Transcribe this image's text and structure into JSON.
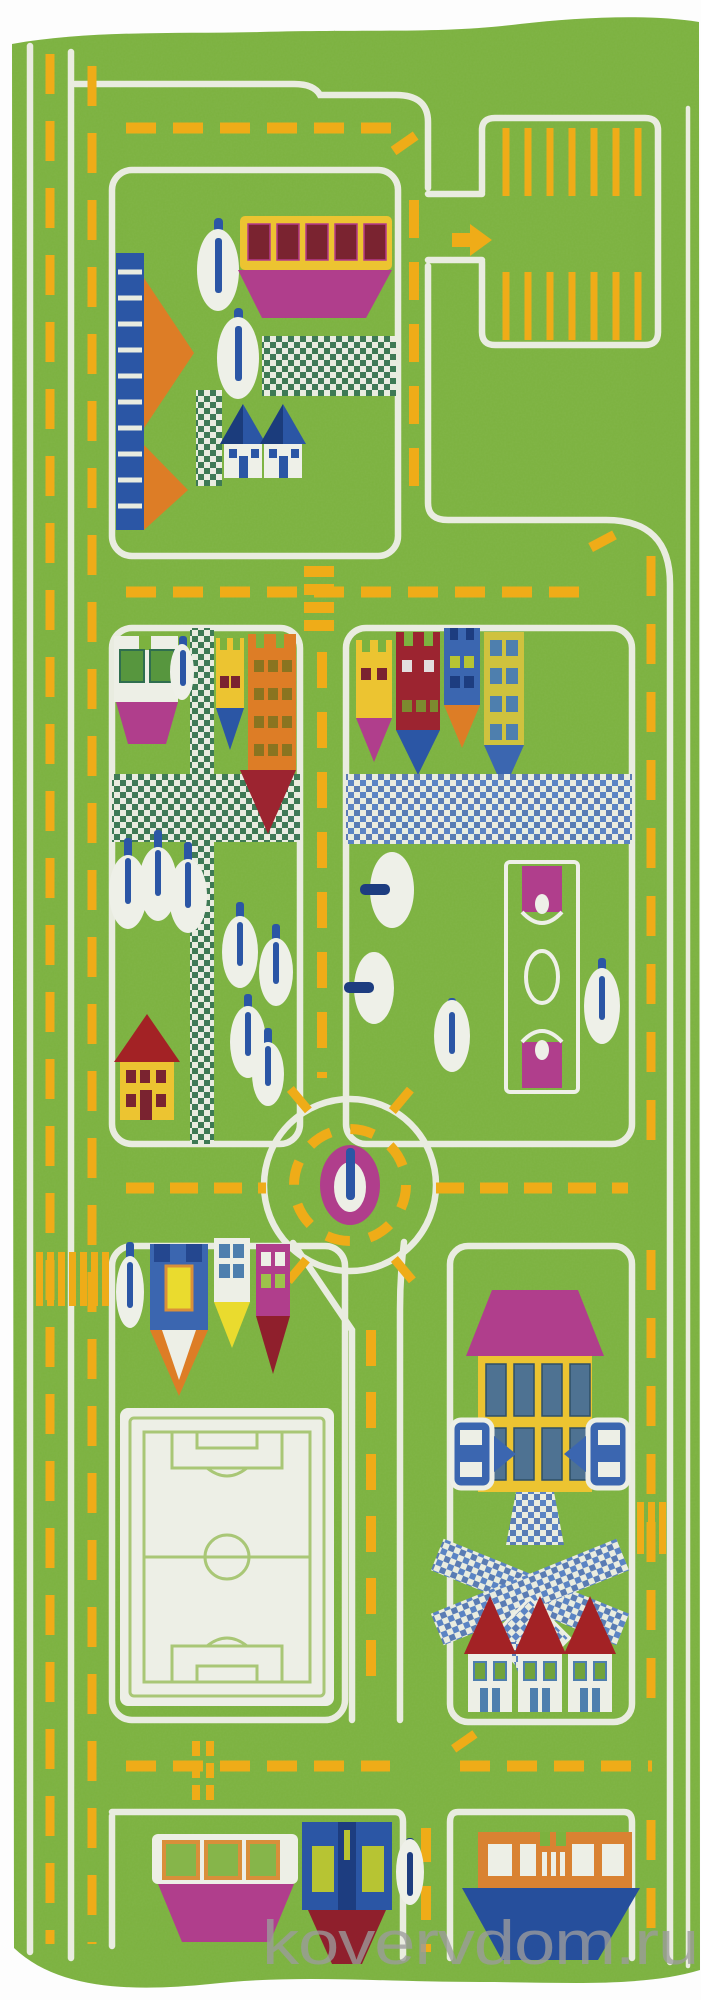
{
  "photo": {
    "kind": "product photo",
    "subject": "children's green city-road play rug, top-down view",
    "width_px": 701,
    "height_px": 2000
  },
  "watermark": {
    "text": "kovervdom.ru",
    "color": "#9c9c9c"
  },
  "palette": {
    "grass_green": "#7cb23f",
    "road_white": "#e9ece0",
    "marking_yellow": "#efac18",
    "magenta": "#b03e8c",
    "dark_red": "#9c2430",
    "roof_red": "#a32225",
    "orange": "#dd7d26",
    "blue": "#2b56a5",
    "navy": "#1d3d80",
    "building_yellow": "#ecc431",
    "checker_teal": "#3e7a55",
    "checker_blue": "#5b84c4",
    "field_line_green": "#a9c776"
  },
  "scene_items": [
    "left two-lane road with yellow dashes",
    "top road with parking lot and yellow stalls and entry arrow",
    "school bus building with magenta base",
    "playground ladder and orange slide",
    "checkerboard plazas and paths",
    "houses with blue roofs",
    "apartment buildings (white, yellow, orange, red, blue towers)",
    "trees as white ovals with blue trunks",
    "basketball court",
    "red-roof house",
    "roundabout with magenta island tree",
    "zebra crossing",
    "soccer field",
    "large house with magenta roof and two cars",
    "three small red-roof houses",
    "tram, blue wagon and boat at bottom"
  ]
}
